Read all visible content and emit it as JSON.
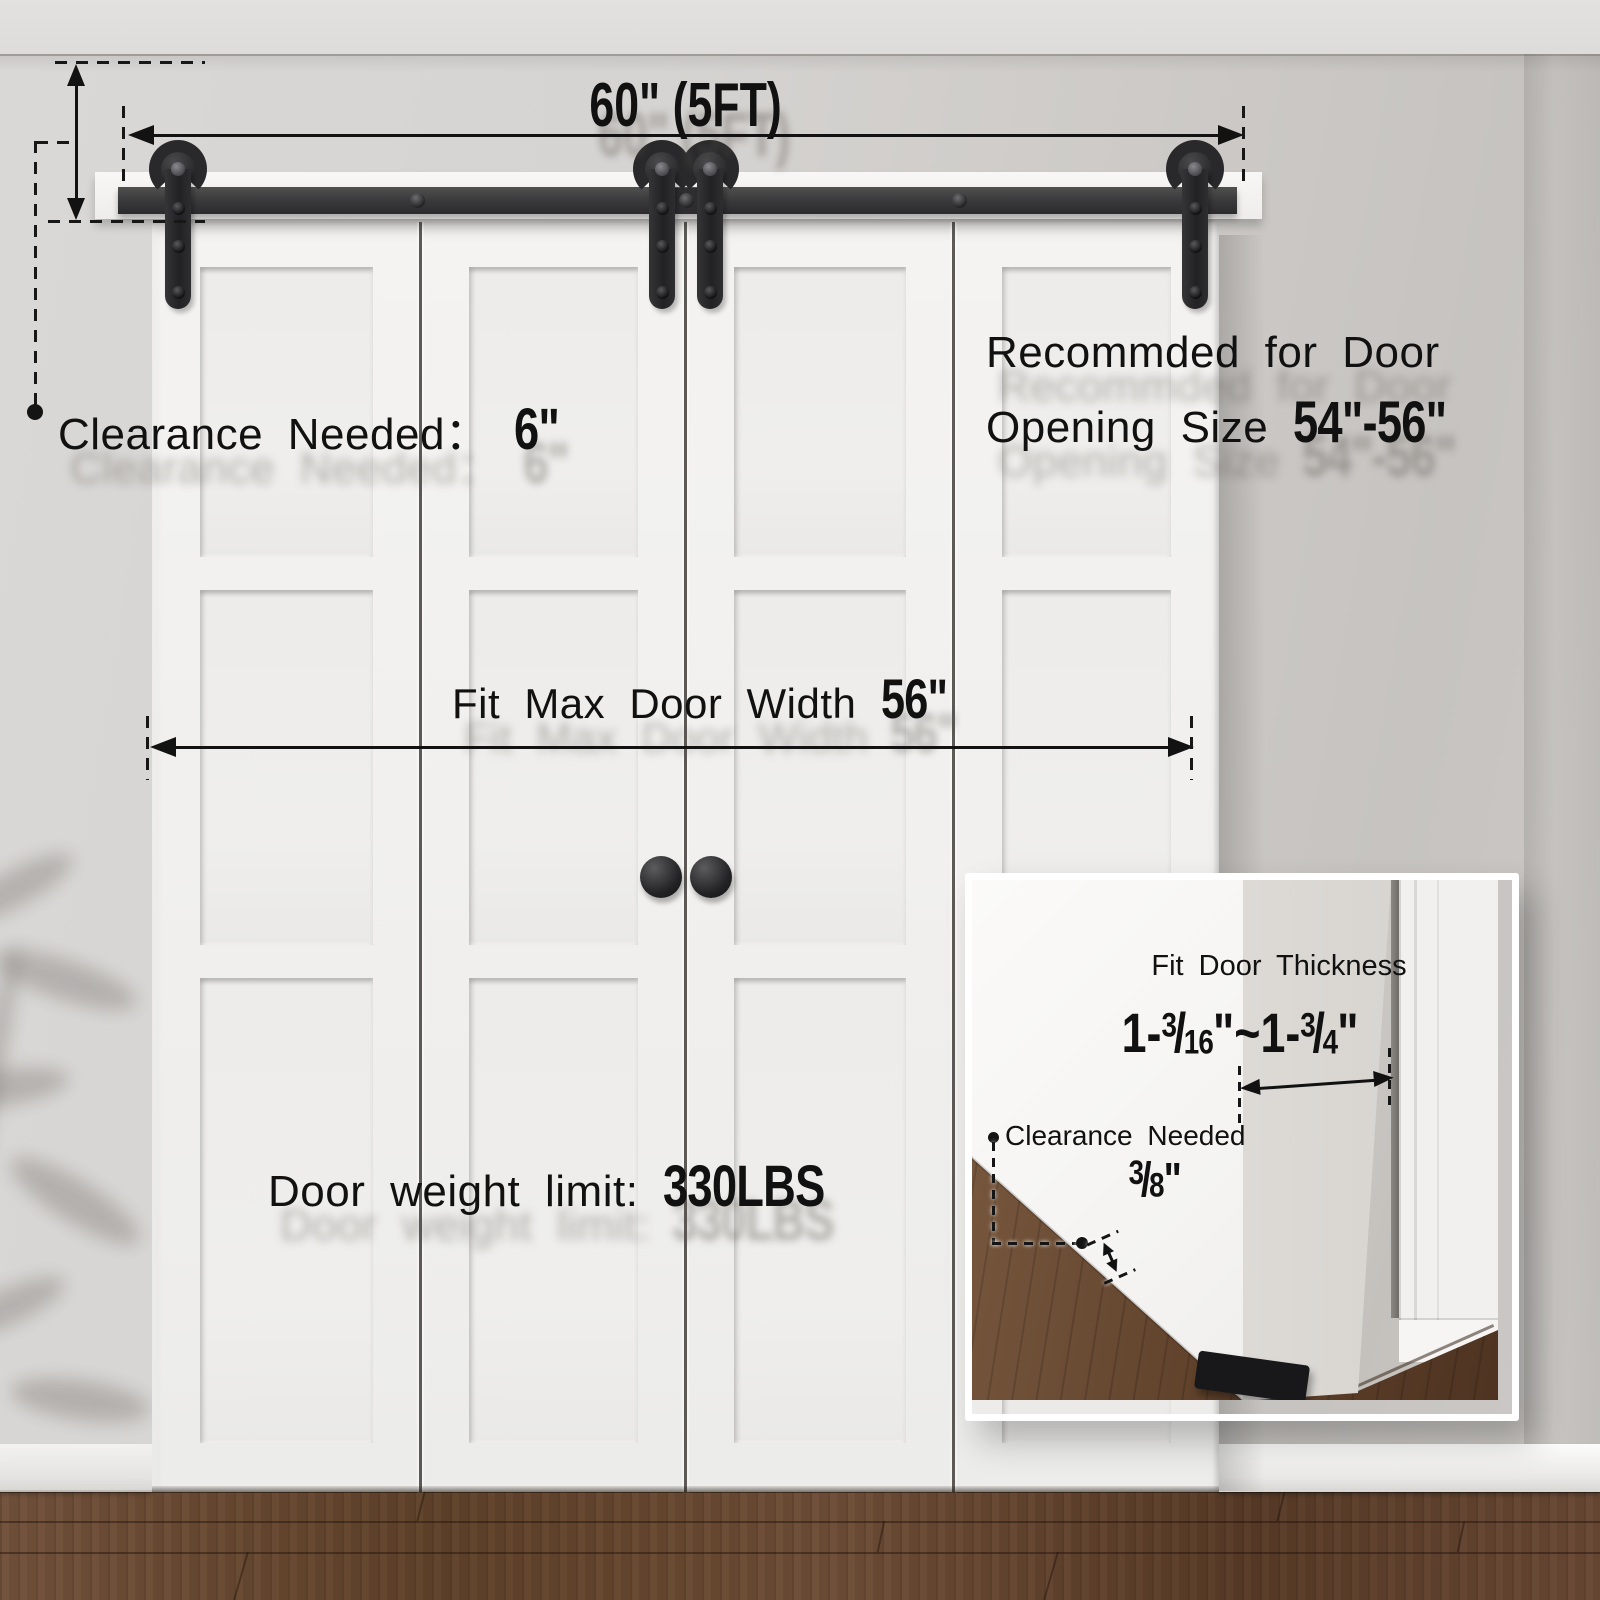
{
  "colors": {
    "hardware_black": "#2b2b2d",
    "annotation_text": "#111111",
    "wall_gray": "#d3d0cd",
    "door_white": "#f2f1ef",
    "floor_wood": "#6a4a34"
  },
  "dimensions": {
    "track_length": "60\" (5FT)",
    "clearance": {
      "label": "Clearance Needed：",
      "value": "6\""
    },
    "recommended": {
      "line1": "Recommded for Door",
      "line2_label": "Opening Size",
      "value": "54\"-56\""
    },
    "max_door_width": {
      "label": "Fit Max Door Width",
      "value": "56\""
    },
    "door_weight": {
      "label": "Door weight limit:",
      "value": "330LBS"
    }
  },
  "inset": {
    "door_thickness": {
      "label": "Fit Door Thickness",
      "min": {
        "whole": "1-",
        "numerator": "3",
        "denominator": "16",
        "unit": "\""
      },
      "separator": "~",
      "max": {
        "whole": "1-",
        "numerator": "3",
        "denominator": "4",
        "unit": "\""
      }
    },
    "floor_clearance": {
      "label": "Clearance Needed",
      "numerator": "3",
      "denominator": "8",
      "unit": "\""
    }
  }
}
